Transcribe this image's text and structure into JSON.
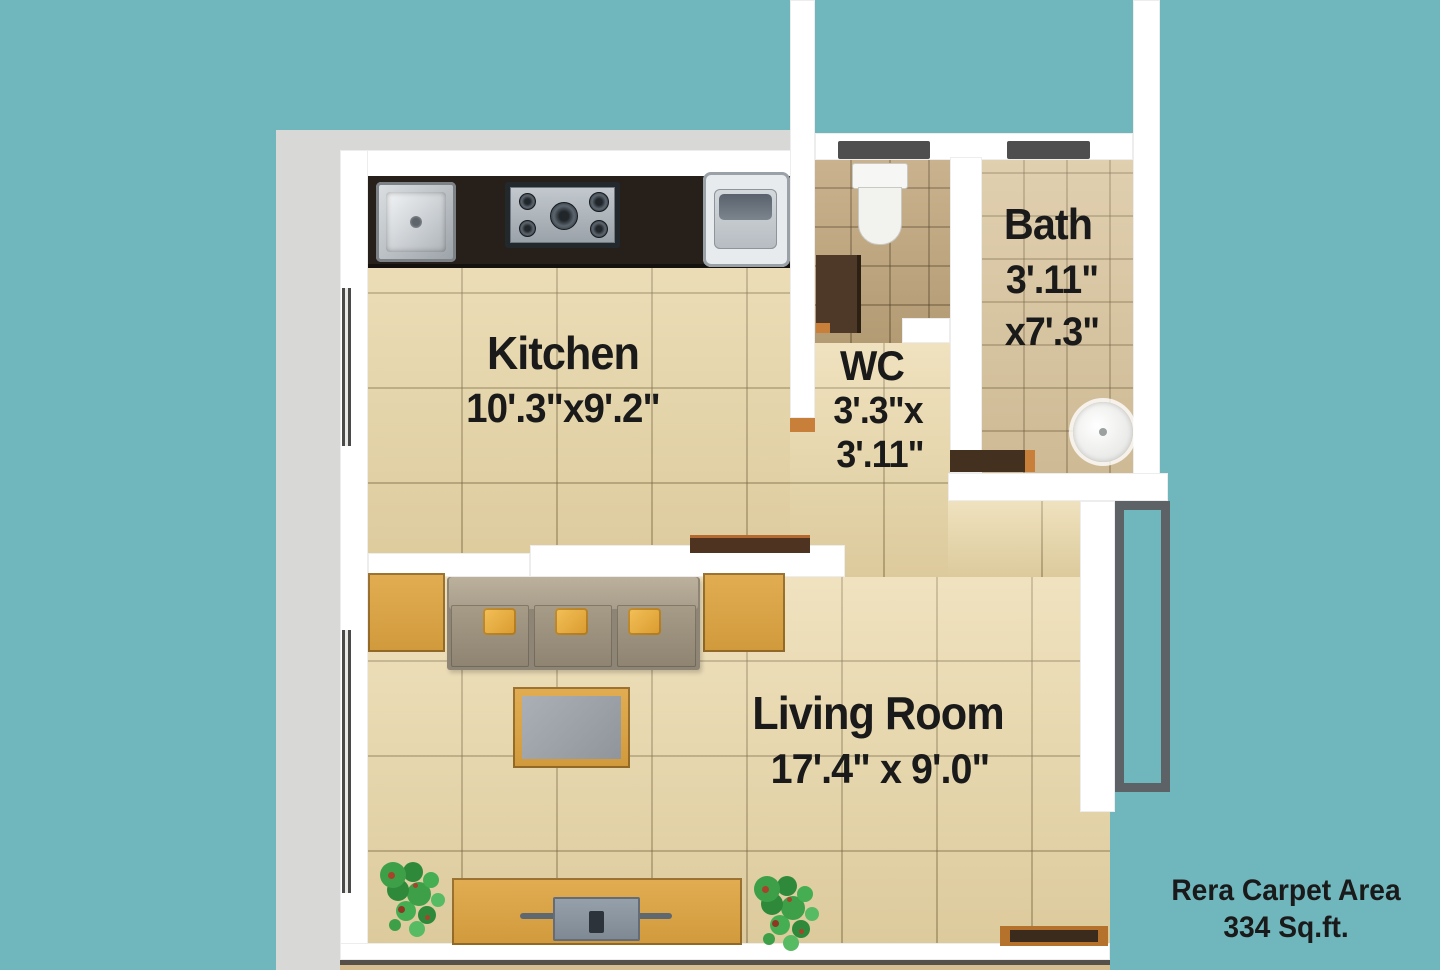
{
  "plan": {
    "type": "residential floor plan (top view)",
    "rooms": [
      {
        "id": "kitchen",
        "name": "Kitchen",
        "dimensions": "10'.3\"x9'.2\""
      },
      {
        "id": "wc",
        "name": "WC",
        "dim1": "3'.3\"x",
        "dim2": "3'.11\""
      },
      {
        "id": "bath",
        "name": "Bath",
        "dim1": "3'.11\"",
        "dim2": "x7'.3\""
      },
      {
        "id": "living-room",
        "name": "Living Room",
        "dimensions": "17'.4\" x 9'.0\""
      }
    ],
    "fixtures": [
      "kitchen-sink",
      "gas-stove",
      "washing-machine",
      "toilet",
      "wash-basin",
      "sofa",
      "coffee-table",
      "side-tables",
      "tv-unit",
      "television",
      "plants"
    ]
  },
  "footer": {
    "line1": "Rera Carpet Area",
    "line2": "334 Sq.ft."
  },
  "colors": {
    "background_teal": "#6fb6bd",
    "wall_white": "#ffffff",
    "outer_margin_gray": "#d8d8d6",
    "floor_cream": "#ead7a6",
    "floor_wc": "#c2a87e",
    "floor_bath": "#d9c49c",
    "counter_dark": "#27201a",
    "wood": "#d9a344",
    "sofa_taupe": "#a79c8a",
    "pillow_yellow": "#ecb246",
    "plant_green": "#3f9d45",
    "lintel_gray": "#4e4e4e",
    "duct_outline": "#5d6267",
    "text_dark": "#1a1a1a"
  }
}
